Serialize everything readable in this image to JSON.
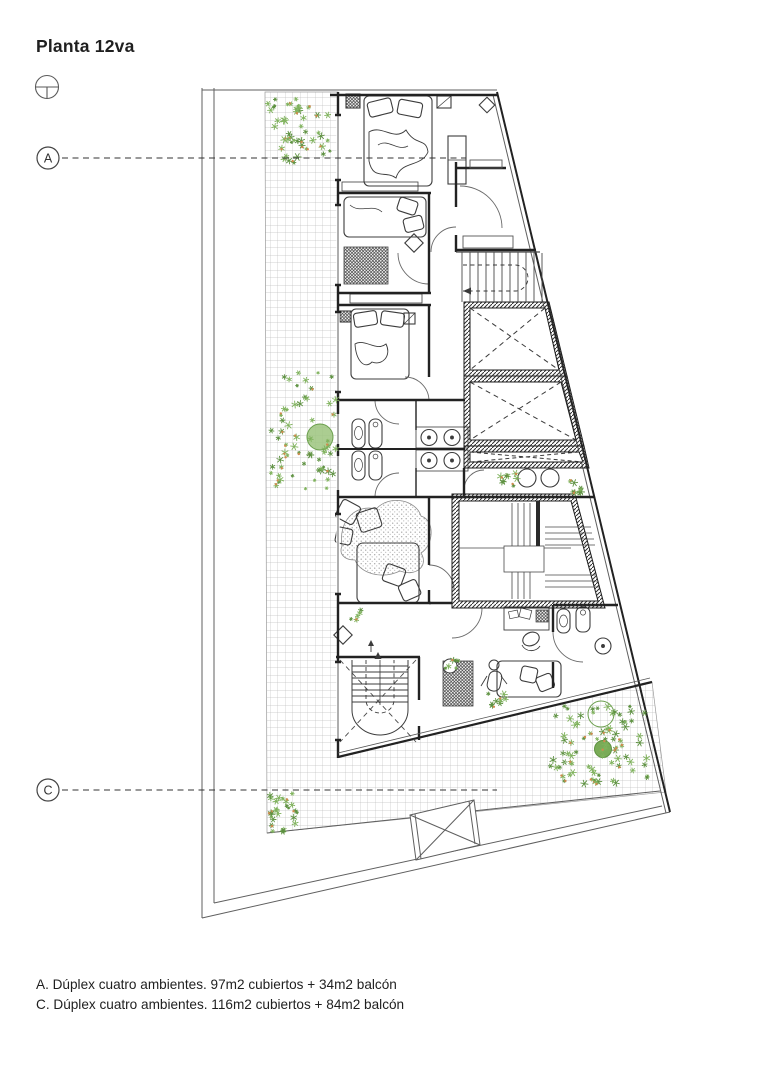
{
  "page": {
    "title": "Planta 12va"
  },
  "section_markers": {
    "a": {
      "label": "A"
    },
    "c": {
      "label": "C"
    }
  },
  "legend": {
    "line_a": "A. Dúplex cuatro ambientes. 97m2 cubiertos + 34m2 balcón",
    "line_c": "C. Dúplex cuatro ambientes. 116m2 cubiertos + 84m2 balcón"
  },
  "icons": {
    "north": "north-indicator-icon"
  },
  "colors": {
    "ink": "#3a3a3a",
    "wall": "#1e1e1e",
    "thin": "#5a5a5a",
    "grid": "#c0c0c0",
    "plant_green": "#7fb25c",
    "plant_dark": "#5d9140",
    "plant_orange": "#cf8a4e"
  }
}
